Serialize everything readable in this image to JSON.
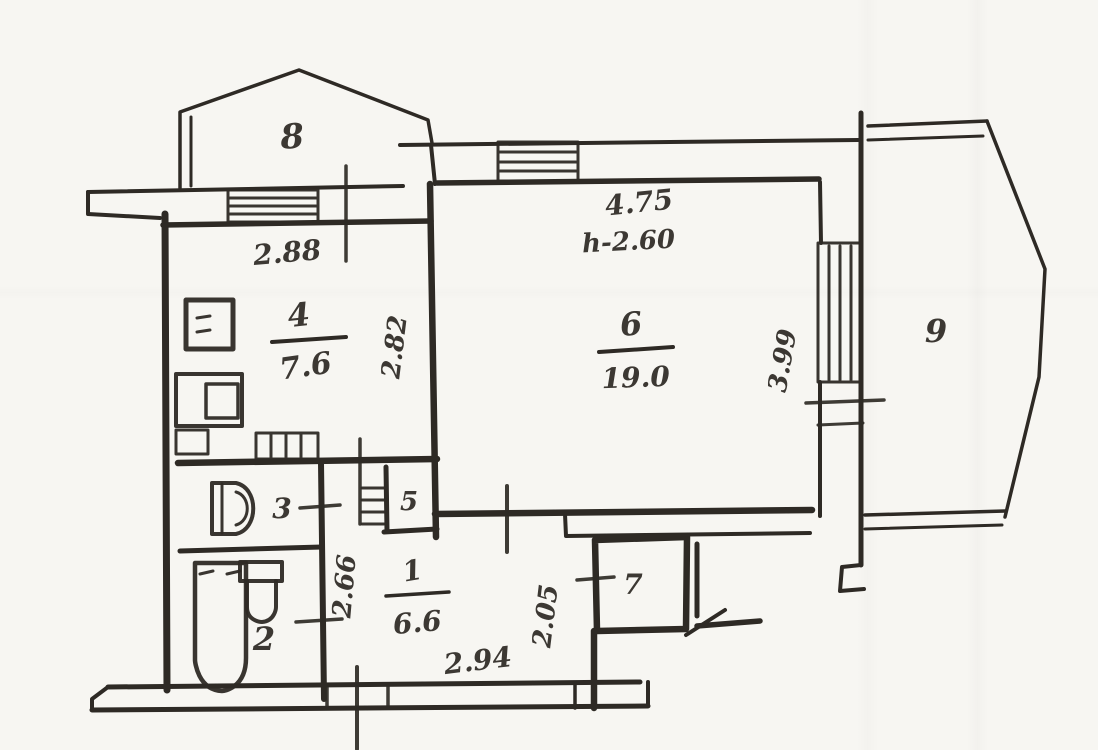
{
  "plan": {
    "rooms": {
      "r1": {
        "number": "1",
        "area": "6.6"
      },
      "r2": {
        "number": "2"
      },
      "r3": {
        "number": "3"
      },
      "r4": {
        "number": "4",
        "area": "7.6"
      },
      "r5": {
        "number": "5"
      },
      "r6": {
        "number": "6",
        "area": "19.0",
        "ceiling_note": "h-2.60"
      },
      "r7": {
        "number": "7"
      },
      "r8": {
        "number": "8"
      },
      "r9": {
        "number": "9"
      }
    },
    "dimensions": {
      "d288": "2.88",
      "d282": "2.82",
      "d475": "4.75",
      "d399": "3.99",
      "d266": "2.66",
      "d294": "2.94",
      "d205": "2.05"
    },
    "colors": {
      "ink": "#2e2a25",
      "paper": "#f7f6f2"
    }
  }
}
